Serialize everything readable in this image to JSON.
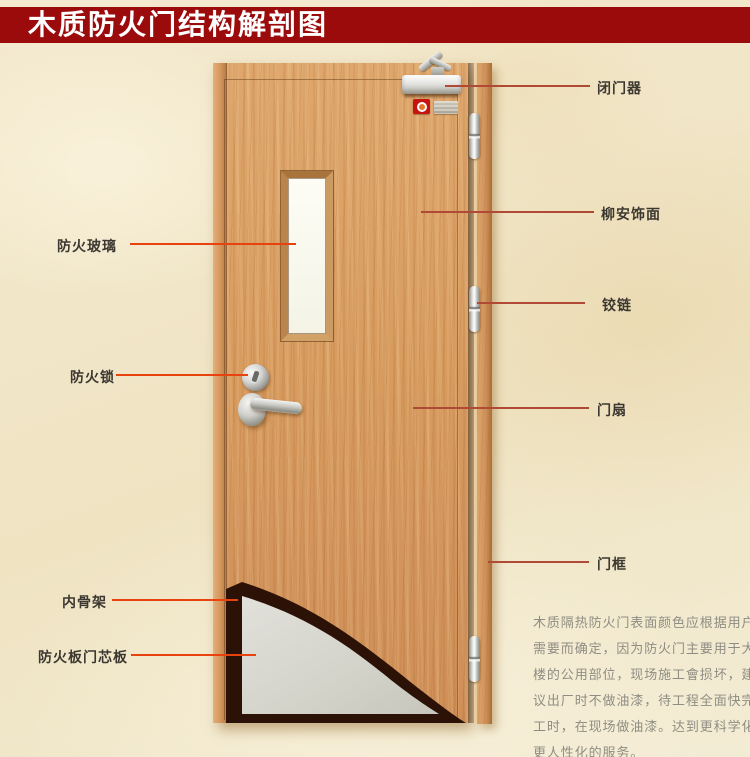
{
  "title": "木质防火门结构解剖图",
  "colors": {
    "banner_red": "#9c0b0c",
    "leader_line_left": "#e8430f",
    "leader_line_right": "#b04a36",
    "door_wood": "#d79c60",
    "core_board_gray": "#d5d5cc",
    "inner_skeleton_dark": "#2b1208",
    "description_text": "#8f8d83"
  },
  "labels": {
    "left": [
      {
        "id": "fire-glass",
        "text": "防火玻璃"
      },
      {
        "id": "fire-lock",
        "text": "防火锁"
      },
      {
        "id": "inner-skeleton",
        "text": "内骨架"
      },
      {
        "id": "fire-board-core",
        "text": "防火板门芯板"
      }
    ],
    "right": [
      {
        "id": "door-closer",
        "text": "闭门器"
      },
      {
        "id": "lauan-veneer",
        "text": "柳安饰面"
      },
      {
        "id": "hinge",
        "text": "铰链"
      },
      {
        "id": "door-leaf",
        "text": "门扇"
      },
      {
        "id": "door-frame",
        "text": "门框"
      }
    ]
  },
  "description": {
    "lines": [
      "木质隔热防火门表面颜色应根据用户",
      "需要而确定，因为防火门主要用于大",
      "楼的公用部位，现场施工會损坏，建",
      "议出厂时不做油漆，待工程全面快完",
      "工时，在现场做油漆。达到更科学化",
      "更人性化的服务。"
    ]
  }
}
